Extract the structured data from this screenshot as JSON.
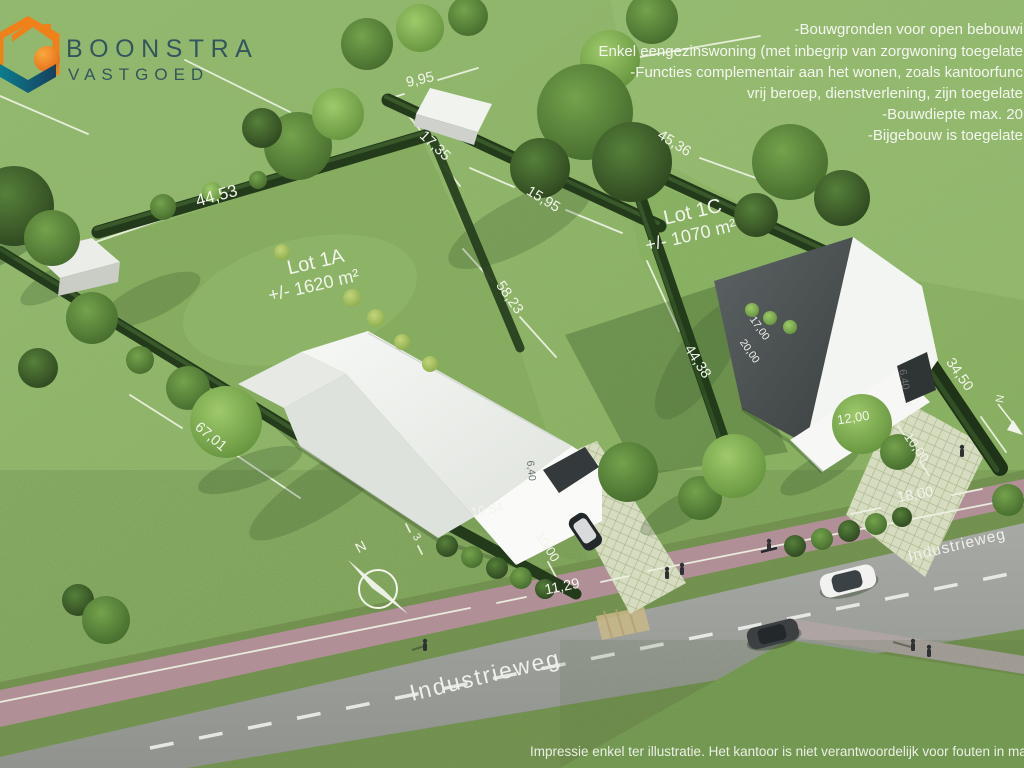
{
  "brand": {
    "name": "BOONSTRA",
    "sub": "VASTGOED"
  },
  "regulations": [
    "-Bouwgronden voor open bebouwi",
    "Enkel eengezinswoning (met inbegrip van zorgwoning toegelate",
    "-Functies complementair aan het wonen, zoals kantoorfunc",
    "vrij beroep, dienstverlening, zijn toegelate",
    "-Bouwdiepte max. 20",
    "-Bijgebouw is toegelate"
  ],
  "lots": [
    {
      "name": "Lot 1A",
      "area": "+/- 1620 m²"
    },
    {
      "name": "Lot 1C",
      "area": "+/- 1070 m²"
    }
  ],
  "dims": {
    "d44_53": "44,53",
    "d9_95": "9,95",
    "d17_35": "17,35",
    "d15_95": "15,95",
    "d45_36": "45,36",
    "d58_23": "58,23",
    "d44_38": "44,38",
    "d67_01": "67,01",
    "d34_50": "34,50",
    "d17_00": "17,00",
    "d20_00": "20,00",
    "d6_40_a": "6,40",
    "d6_40_b": "6,40",
    "d10_54": "10,54",
    "d3": "3",
    "d10_00_a": "10,00",
    "d12_00": "12,00",
    "d10_00_b": "10,00",
    "d18_00": "18,00",
    "d11_29": "11,29"
  },
  "street": {
    "label": "Industrieweg"
  },
  "compass": {
    "north": "N"
  },
  "disclaimer": "Impressie enkel ter illustratie. Het kantoor is niet verantwoordelijk voor fouten in maten en/of plann",
  "colors": {
    "grass": "#92b96b",
    "hedge": "#233a1b",
    "road": "#9b9e99",
    "cycle_path": "#b18f97",
    "logo_orange": "#f08019",
    "logo_teal": "#0d7c8c",
    "logo_navy": "#16405f",
    "logo_text": "#33565e",
    "label_white": "#f2f5ec"
  }
}
